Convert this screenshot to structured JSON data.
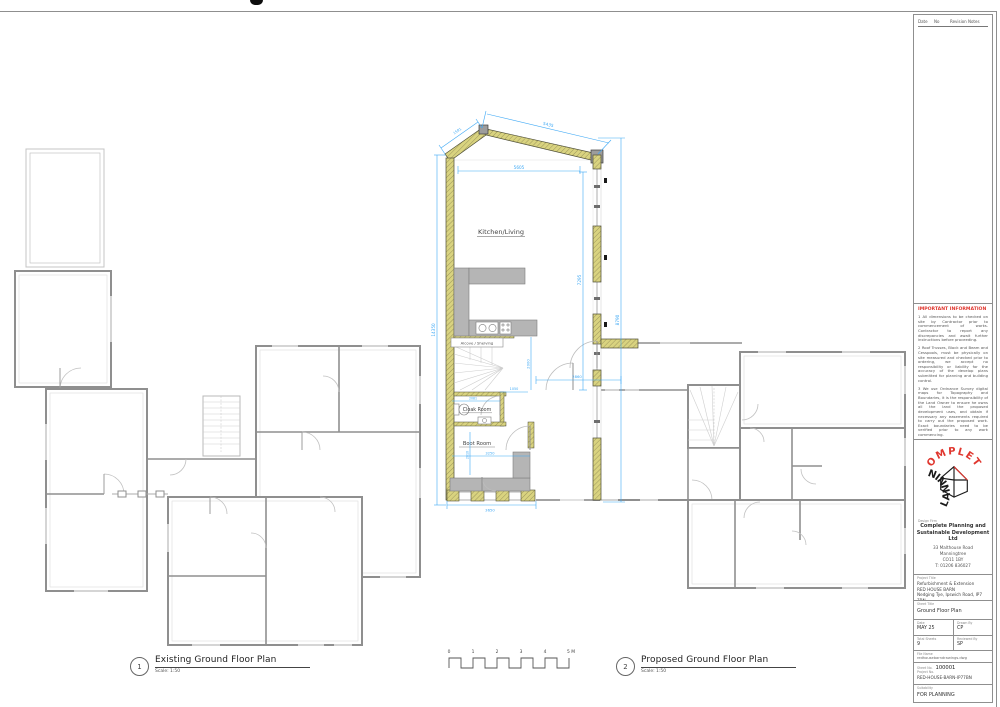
{
  "titleblock": {
    "revisions": {
      "col_date": "Date",
      "col_no": "No",
      "col_notes": "Revision Notes"
    },
    "important_info": {
      "title": "IMPORTANT INFORMATION",
      "notes": [
        "1    All dimensions to be checked on site by Contractor prior to commencement of works. Contractor to report any discrepancies and await further instructions before proceeding.",
        "2    Roof Trusses, Block and Beam and Cesspools, must be physically on site measured and checked prior to ordering, we accept no responsibility or liability for the accuracy of the develop plans submitted for planning and building control.",
        "3    We use Ordnance Survey digital maps for Topography and Boundaries, it is the responsibility of the Land Owner to ensure he owns all the land the proposed development uses, and obtain if necessary any easements required to carry out the proposed work. Exact boundaries need to be verified prior to any work commencing.",
        "4    All building materials and techniques must be agreed to be compliant by Building Control prior to commencement."
      ]
    },
    "logo": {
      "arc_top": "COMPLETE",
      "arc_bottom": "PLANNING"
    },
    "firm": {
      "label": "Design Firm",
      "name1": "Complete Planning and",
      "name2": "Sustainable Development Ltd",
      "address": [
        "33 Malthouse Road",
        "Manningtree",
        "CO11 1BY",
        "T: 01206 836027"
      ]
    },
    "project": {
      "label": "Project Title",
      "line1": "Refurbishment & Extension",
      "line2": "RED HOUSE BARN",
      "line3": "Nedging Tye, Ipswich Road, IP7 7BN"
    },
    "sheet_title": {
      "label": "Sheet Title",
      "value": "Ground Floor Plan"
    },
    "meta": {
      "date_label": "Date",
      "date_value": "MAY 25",
      "drawn_label": "Drawn By",
      "drawn_value": "CP",
      "sheets_label": "Total Sheets",
      "sheets_value": "9",
      "reviewed_label": "Reviewed By",
      "reviewed_value": "SP"
    },
    "file": {
      "label": "File Name",
      "value": "redhousebarndrawings.dwg"
    },
    "number": {
      "label": "Sheet No.",
      "value": "100001",
      "code_label": "Project No.",
      "code_value": "RED-HOUSE-BARN-IP77BN"
    },
    "suitability": {
      "label": "Suitability",
      "value": "FOR PLANNING"
    }
  },
  "captions": {
    "existing": {
      "number": "1",
      "title": "Existing Ground Floor Plan",
      "scale": "Scale: 1:50"
    },
    "proposed": {
      "number": "2",
      "title": "Proposed Ground Floor Plan",
      "scale": "Scale: 1:50"
    }
  },
  "scalebar": {
    "labels": [
      "0",
      "1",
      "2",
      "3",
      "4",
      "5 M"
    ]
  },
  "plan": {
    "rooms": {
      "kitchen_living": "Kitchen/Living",
      "alcove": "Alcove / Shelving",
      "cloak": "Cloak Room",
      "boot": "Boot Room"
    },
    "dimensions": {
      "top_slope": "5435",
      "top_slope_short": "1591",
      "top_inner": "5605",
      "left_total": "14350",
      "right_outer": "8790",
      "right_inner": "7295",
      "hall": "2000",
      "link": "2860",
      "hall_door": "1050",
      "cloak_width": "2081",
      "boot_width": "3250",
      "boot_depth": "2810",
      "bottom": "3650"
    }
  },
  "colors": {
    "dimension": "#3fa9f5",
    "new_wall": "#d9d37f",
    "existing_wall": "#8c8c8c",
    "accent_red": "#e0372f"
  }
}
